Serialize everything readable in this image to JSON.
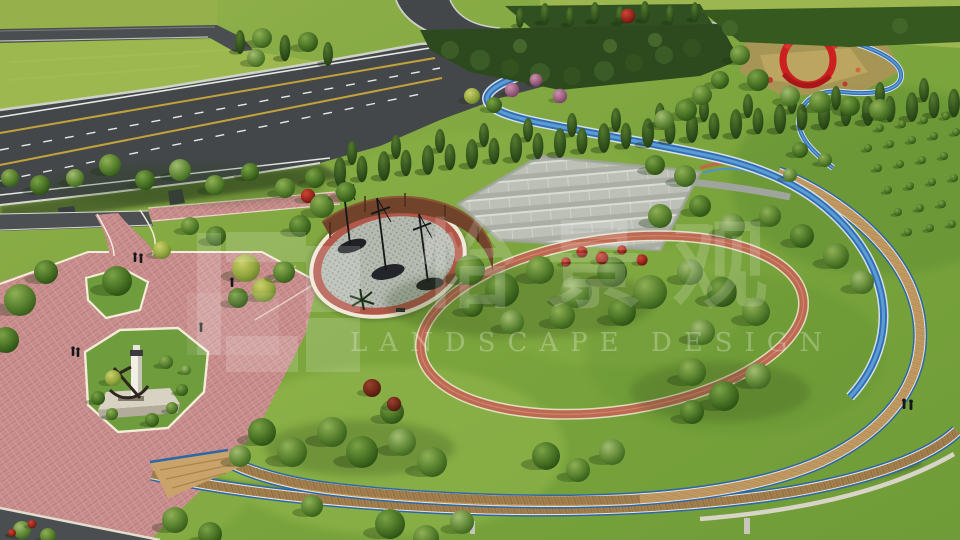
{
  "image": {
    "type": "aerial-3d-landscape-rendering",
    "subject": "park with highway interchange, circular greenway loop, sculpture plaza and memorial plaza"
  },
  "watermark": {
    "logo": "white-block-grid-logo",
    "cn_text": "怡景观",
    "en_text": "LANDSCAPE DESIGN"
  },
  "palette": {
    "grass": "#7ca53d",
    "upper_field": "#9db84e",
    "asphalt": "#43474a",
    "concrete_trim": "#cfd2ca",
    "plaza_pink": "#c98f8e",
    "path_red_brick": "#bd6a52",
    "greenway_blue": "#2f6fb5",
    "greenway_blue_light": "#5d9bd3",
    "deck_tan": "#c29a63",
    "deck_wood": "#a3804e",
    "corten_wall": "#70432a",
    "ribbon_sculpture_red": "#cc1f1f",
    "monument_white": "#f2efe6",
    "parking_gray": "#bcc0b7",
    "white_trim": "#f2ecd8"
  }
}
